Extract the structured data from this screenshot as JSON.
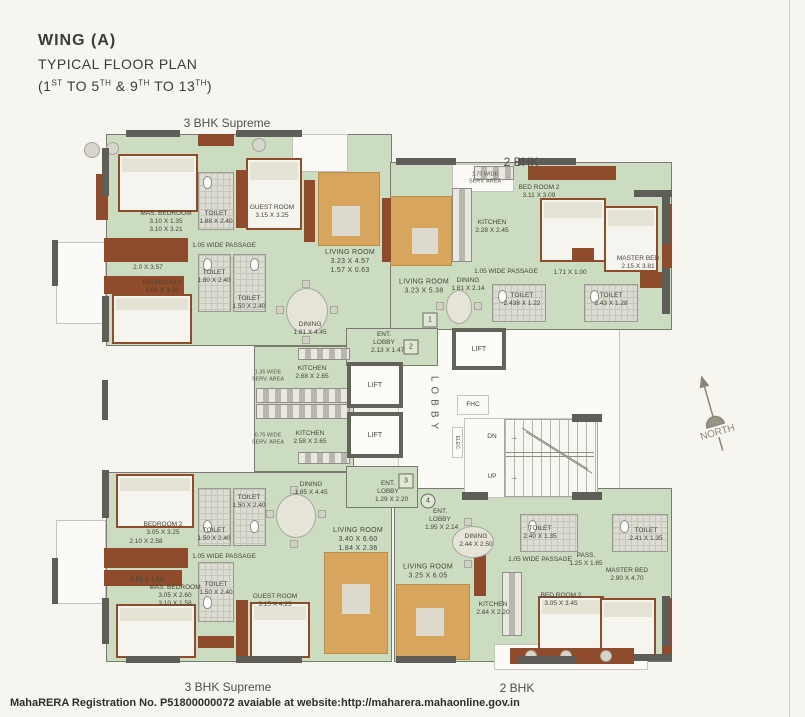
{
  "title": {
    "line1": "WING (A)",
    "line2": "TYPICAL FLOOR PLAN",
    "floors": {
      "p1": "(1",
      "s1": "ST",
      "p2": " TO 5",
      "s2": "TH",
      "p3": " & 9",
      "s3": "TH",
      "p4": " TO 13",
      "s4": "TH",
      "p5": ")"
    }
  },
  "unit_labels": {
    "top_left": "3 BHK Supreme",
    "top_right": "2 BHK",
    "bottom_left": "3 BHK Supreme",
    "bottom_right": "2 BHK"
  },
  "core": {
    "lift": "LIFT",
    "lobby": "LOBBY",
    "fhc": "FHC",
    "elec": "ELEC.",
    "dn": "DN",
    "up": "UP",
    "arrow": "→",
    "north": "NORTH"
  },
  "flat_numbers": {
    "f1": "1",
    "f2": "2",
    "f3": "3",
    "f4": "4"
  },
  "units": {
    "top_left_3bhk": {
      "rooms": {
        "mas_bedroom": {
          "name": "MAS. BEDROOM",
          "dims": "3.10 X 1.35",
          "dims2": "3.10 X 3.21"
        },
        "guest_room": {
          "name": "GUEST ROOM",
          "dims": "3.15 X 3.25"
        },
        "toilet_1": {
          "name": "TOILET",
          "dims": "1.88 X 2.40"
        },
        "toilet_2": {
          "name": "TOILET",
          "dims": "1.80 X 2.40"
        },
        "toilet_3": {
          "name": "TOILET",
          "dims": "1.50 X 2.40"
        },
        "passage": {
          "name": "1.05 WIDE PASSAGE"
        },
        "balcony": {
          "dims": "2.0 X 3.57"
        },
        "bedroom_2": {
          "name": "BEDROOM 2",
          "dims": "3.05 X 3.25"
        },
        "living_room": {
          "name": "LIVING ROOM",
          "dims": "3.23 X 4.57",
          "dims2": "1.57 X 0.63"
        },
        "dining": {
          "name": "DINING",
          "dims": "1.81 X 4.45"
        },
        "kitchen": {
          "name": "KITCHEN",
          "dims": "2.68 X 2.65"
        },
        "serv_area": {
          "name": "1.35 WIDE SERV. AREA"
        },
        "ent_lobby": {
          "name": "ENT. LOBBY",
          "dims": "2.13 X 1.47"
        }
      }
    },
    "top_right_2bhk": {
      "rooms": {
        "serv_area": {
          "name": "1.75 WIDE SERV. AREA"
        },
        "kitchen": {
          "name": "KITCHEN",
          "dims": "2.28 X 2.45"
        },
        "bedroom_2": {
          "name": "BED ROOM 2",
          "dims": "3.11 X 3.09"
        },
        "master_bed": {
          "name": "MASTER BED",
          "dims": "2.15 X 3.81"
        },
        "living_room": {
          "name": "LIVING ROOM",
          "dims": "3.23 X 5.38"
        },
        "dining": {
          "name": "DINING",
          "dims": "1.81 X 2.14"
        },
        "passage": {
          "name": "1.05 WIDE PASSAGE"
        },
        "pass_dims": {
          "dims": "1.71 X 1.00"
        },
        "toilet_1": {
          "name": "TOILET",
          "dims": "2.438 X 1.22"
        },
        "toilet_2": {
          "name": "TOILET",
          "dims": "2.43 X 1.28"
        }
      }
    },
    "bottom_left_3bhk": {
      "rooms": {
        "bedroom_2": {
          "name": "BEDROOM 2",
          "dims": "3.05 X 3.25"
        },
        "balcony": {
          "dims": "2.10 X 2.58"
        },
        "balcony2": {
          "dims": "2.05 X 1.58"
        },
        "mas_bedroom": {
          "name": "MAS. BEDROOM",
          "dims": "3.05 X 2.60",
          "dims2": "3.10 X 1.58"
        },
        "toilet_1": {
          "name": "TOILET",
          "dims": "1.50 X 2.40"
        },
        "toilet_2": {
          "name": "TOILET",
          "dims": "1.50 X 2.40"
        },
        "toilet_3": {
          "name": "TOILET",
          "dims": "1.50 X 2.40"
        },
        "passage": {
          "name": "1.05 WIDE PASSAGE"
        },
        "guest_room": {
          "name": "GUEST ROOM",
          "dims": "3.15 X 4.25"
        },
        "dining": {
          "name": "DINING",
          "dims": "1.85 X 4.45"
        },
        "living_room": {
          "name": "LIVING ROOM",
          "dims": "3.40 X 6.60",
          "dims2": "1.84 X 2.36"
        },
        "kitchen": {
          "name": "KITCHEN",
          "dims": "2.58 X 2.65"
        },
        "serv_area": {
          "name": "0.75 WIDE SERV. AREA"
        },
        "ent_lobby": {
          "name": "ENT. LOBBY",
          "dims": "1.29 X 2.20"
        }
      }
    },
    "bottom_right_2bhk": {
      "rooms": {
        "ent_lobby": {
          "name": "ENT. LOBBY",
          "dims": "1.95 X 2.14"
        },
        "dining": {
          "name": "DINING",
          "dims": "2.44 X 2.50"
        },
        "living_room": {
          "name": "LIVING ROOM",
          "dims": "3.25 X 6.05"
        },
        "kitchen": {
          "name": "KITCHEN",
          "dims": "2.84 X 2.20"
        },
        "toilet_1": {
          "name": "TOILET",
          "dims": "2.40 X 1.35"
        },
        "toilet_2": {
          "name": "TOILET",
          "dims": "2.41 X 1.35"
        },
        "passage": {
          "name": "1.05 WIDE PASSAGE"
        },
        "pass": {
          "name": "PASS.",
          "dims": "1.25 X 1.65"
        },
        "master_bed": {
          "name": "MASTER BED",
          "dims": "2.90 X 4.70"
        },
        "bedroom_2": {
          "name": "BED ROOM 2",
          "dims": "3.05 X 3.45"
        }
      }
    }
  },
  "footer": {
    "text": "MahaRERA Registration No. P51800000072 avaiable at website:http://maharera.mahaonline.gov.in"
  }
}
